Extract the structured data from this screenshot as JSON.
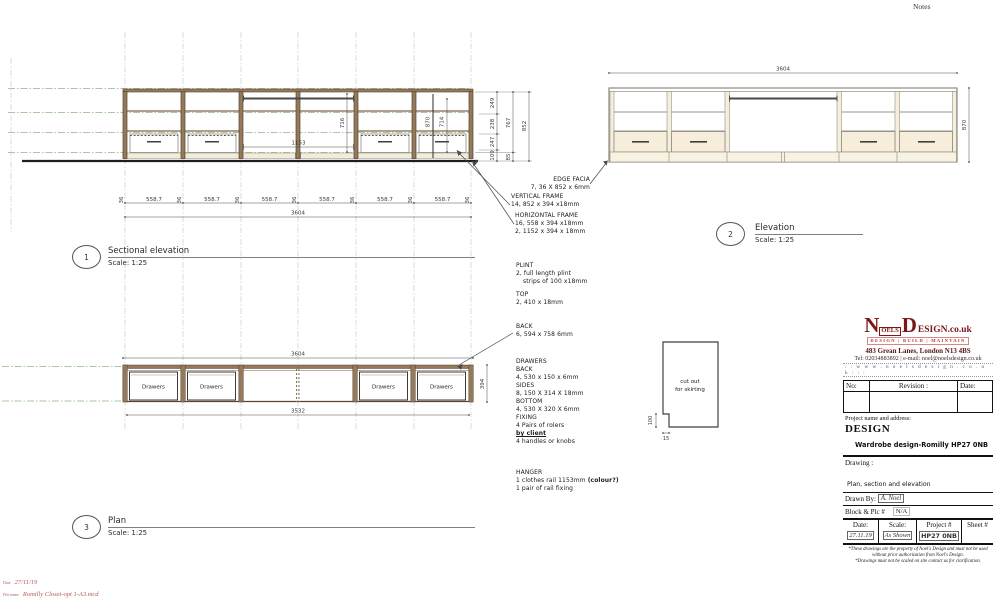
{
  "notes_label": "Notes",
  "views": {
    "sectional": {
      "num": "1",
      "title": "Sectional elevation",
      "scale": "Scale: 1:25"
    },
    "elevation": {
      "num": "2",
      "title": "Elevation",
      "scale": "Scale: 1:25"
    },
    "plan": {
      "num": "3",
      "title": "Plan",
      "scale": "Scale: 1:25"
    }
  },
  "dims": {
    "post": "36",
    "bay": "558.7",
    "total": "3604",
    "hang_w": "1153",
    "hang_h": "716",
    "d870": "870",
    "d714": "714",
    "r249": "249",
    "r238": "238",
    "r247": "247",
    "r109": "109",
    "r85": "85",
    "r767": "767",
    "r852": "852",
    "elev_total": "3604",
    "elev_h": "870",
    "plan_total": "3604",
    "plan_inner": "3532",
    "plan_depth": "394",
    "drawer_label": "Drawers",
    "cut_line1": "cut out",
    "cut_line2": "for skirting",
    "cut_v": "100",
    "cut_h": "15"
  },
  "annotations": {
    "edge_facia": {
      "l1": "EDGE FACIA",
      "l2": "7, 36 X 852 x 6mm"
    },
    "vertical_frame": {
      "l1": "VERTICAL FRAME",
      "l2": "14, 852 x 394 x18mm"
    },
    "horizontal_frame": {
      "l1": "HORIZONTAL FRAME",
      "l2": "16, 558 x 394 x18mm",
      "l3": "2, 1152 x 394 x 18mm"
    },
    "plint": {
      "l1": "PLINT",
      "l2": "2, full length plint",
      "l3": "strips of 100 x18mm"
    },
    "top": {
      "l1": "TOP",
      "l2": "2, 410 x 18mm"
    },
    "back": {
      "l1": "BACK",
      "l2": "6, 594 x 758 6mm"
    },
    "drawers": {
      "l1": "DRAWERS",
      "l2": "BACK",
      "l3": "4, 530 x 150 x 6mm",
      "l4": "SIDES",
      "l5": "8, 150 X 314 X 18mm",
      "l6": "BOTTOM",
      "l7": "4, 530 X 320 X 6mm",
      "l8": "FIXING",
      "l9": "4 Pairs of rolers",
      "l10": "by client",
      "l11": "4 handles or knobs"
    },
    "hanger": {
      "l1": "HANGER",
      "l2a": "1 clothes rail 1153mm ",
      "l2b": "(colour?)",
      "l3": "1 pair of rail fixing"
    }
  },
  "titleblock": {
    "logo": {
      "n": "N",
      "oels": "OELS",
      "d": "D",
      "esign": "ESIGN.co.uk",
      "tagline": "DESIGN | BUILD | MAINTAIN"
    },
    "address": "483 Grean Lanes, London N13 4BS",
    "contact": "Tel: 02034883892 | e-mail: noel@noelsdesign.co.uk",
    "website": ": : w w w . n o e l s d e s i g n . c o . u k : : :",
    "rev_table": {
      "no": "No:",
      "revision": "Revision :",
      "date": "Date:"
    },
    "project_label": "Project name and address:",
    "company": "DESIGN",
    "project_name": "Wardrobe design-Romilly HP27 0NB",
    "drawing_label": "Drawing :",
    "drawing_title": "Plan, section and elevation",
    "drawn_by_label": "Drawn By:",
    "drawn_by_value": "A. Noel",
    "block_label": "Block & Plc #",
    "block_value": "N/A",
    "info_table": {
      "date_label": "Date:",
      "date_value": "27.11.19",
      "scale_label": "Scale:",
      "scale_value": "As Shown",
      "project_label": "Project #",
      "project_value": "HP27 0NB",
      "sheet_label": "Sheet #"
    },
    "disclaimer1": "*These drawings are the property of Noel's Design and must not be used",
    "disclaimer2": "without   prior authorization from Noel's Design.",
    "disclaimer3": "*Drawings must not be scaled on site contact us for clarification."
  },
  "footer": {
    "date_label": "Date",
    "date_value": "27/11/19",
    "file_label": "File name",
    "file_value": "Romilly Closet-opt 1-A3.mcd"
  },
  "colors": {
    "wood": "#94795a",
    "wood_dark": "#57452f",
    "cream": "#f6eeda",
    "green_line": "#a9c7a0",
    "grid": "#cfd6c9",
    "dim": "#4a4a4a",
    "logo_red": "#7a1818",
    "accent_red": "#c23434",
    "footer_red": "#b25c5c"
  }
}
